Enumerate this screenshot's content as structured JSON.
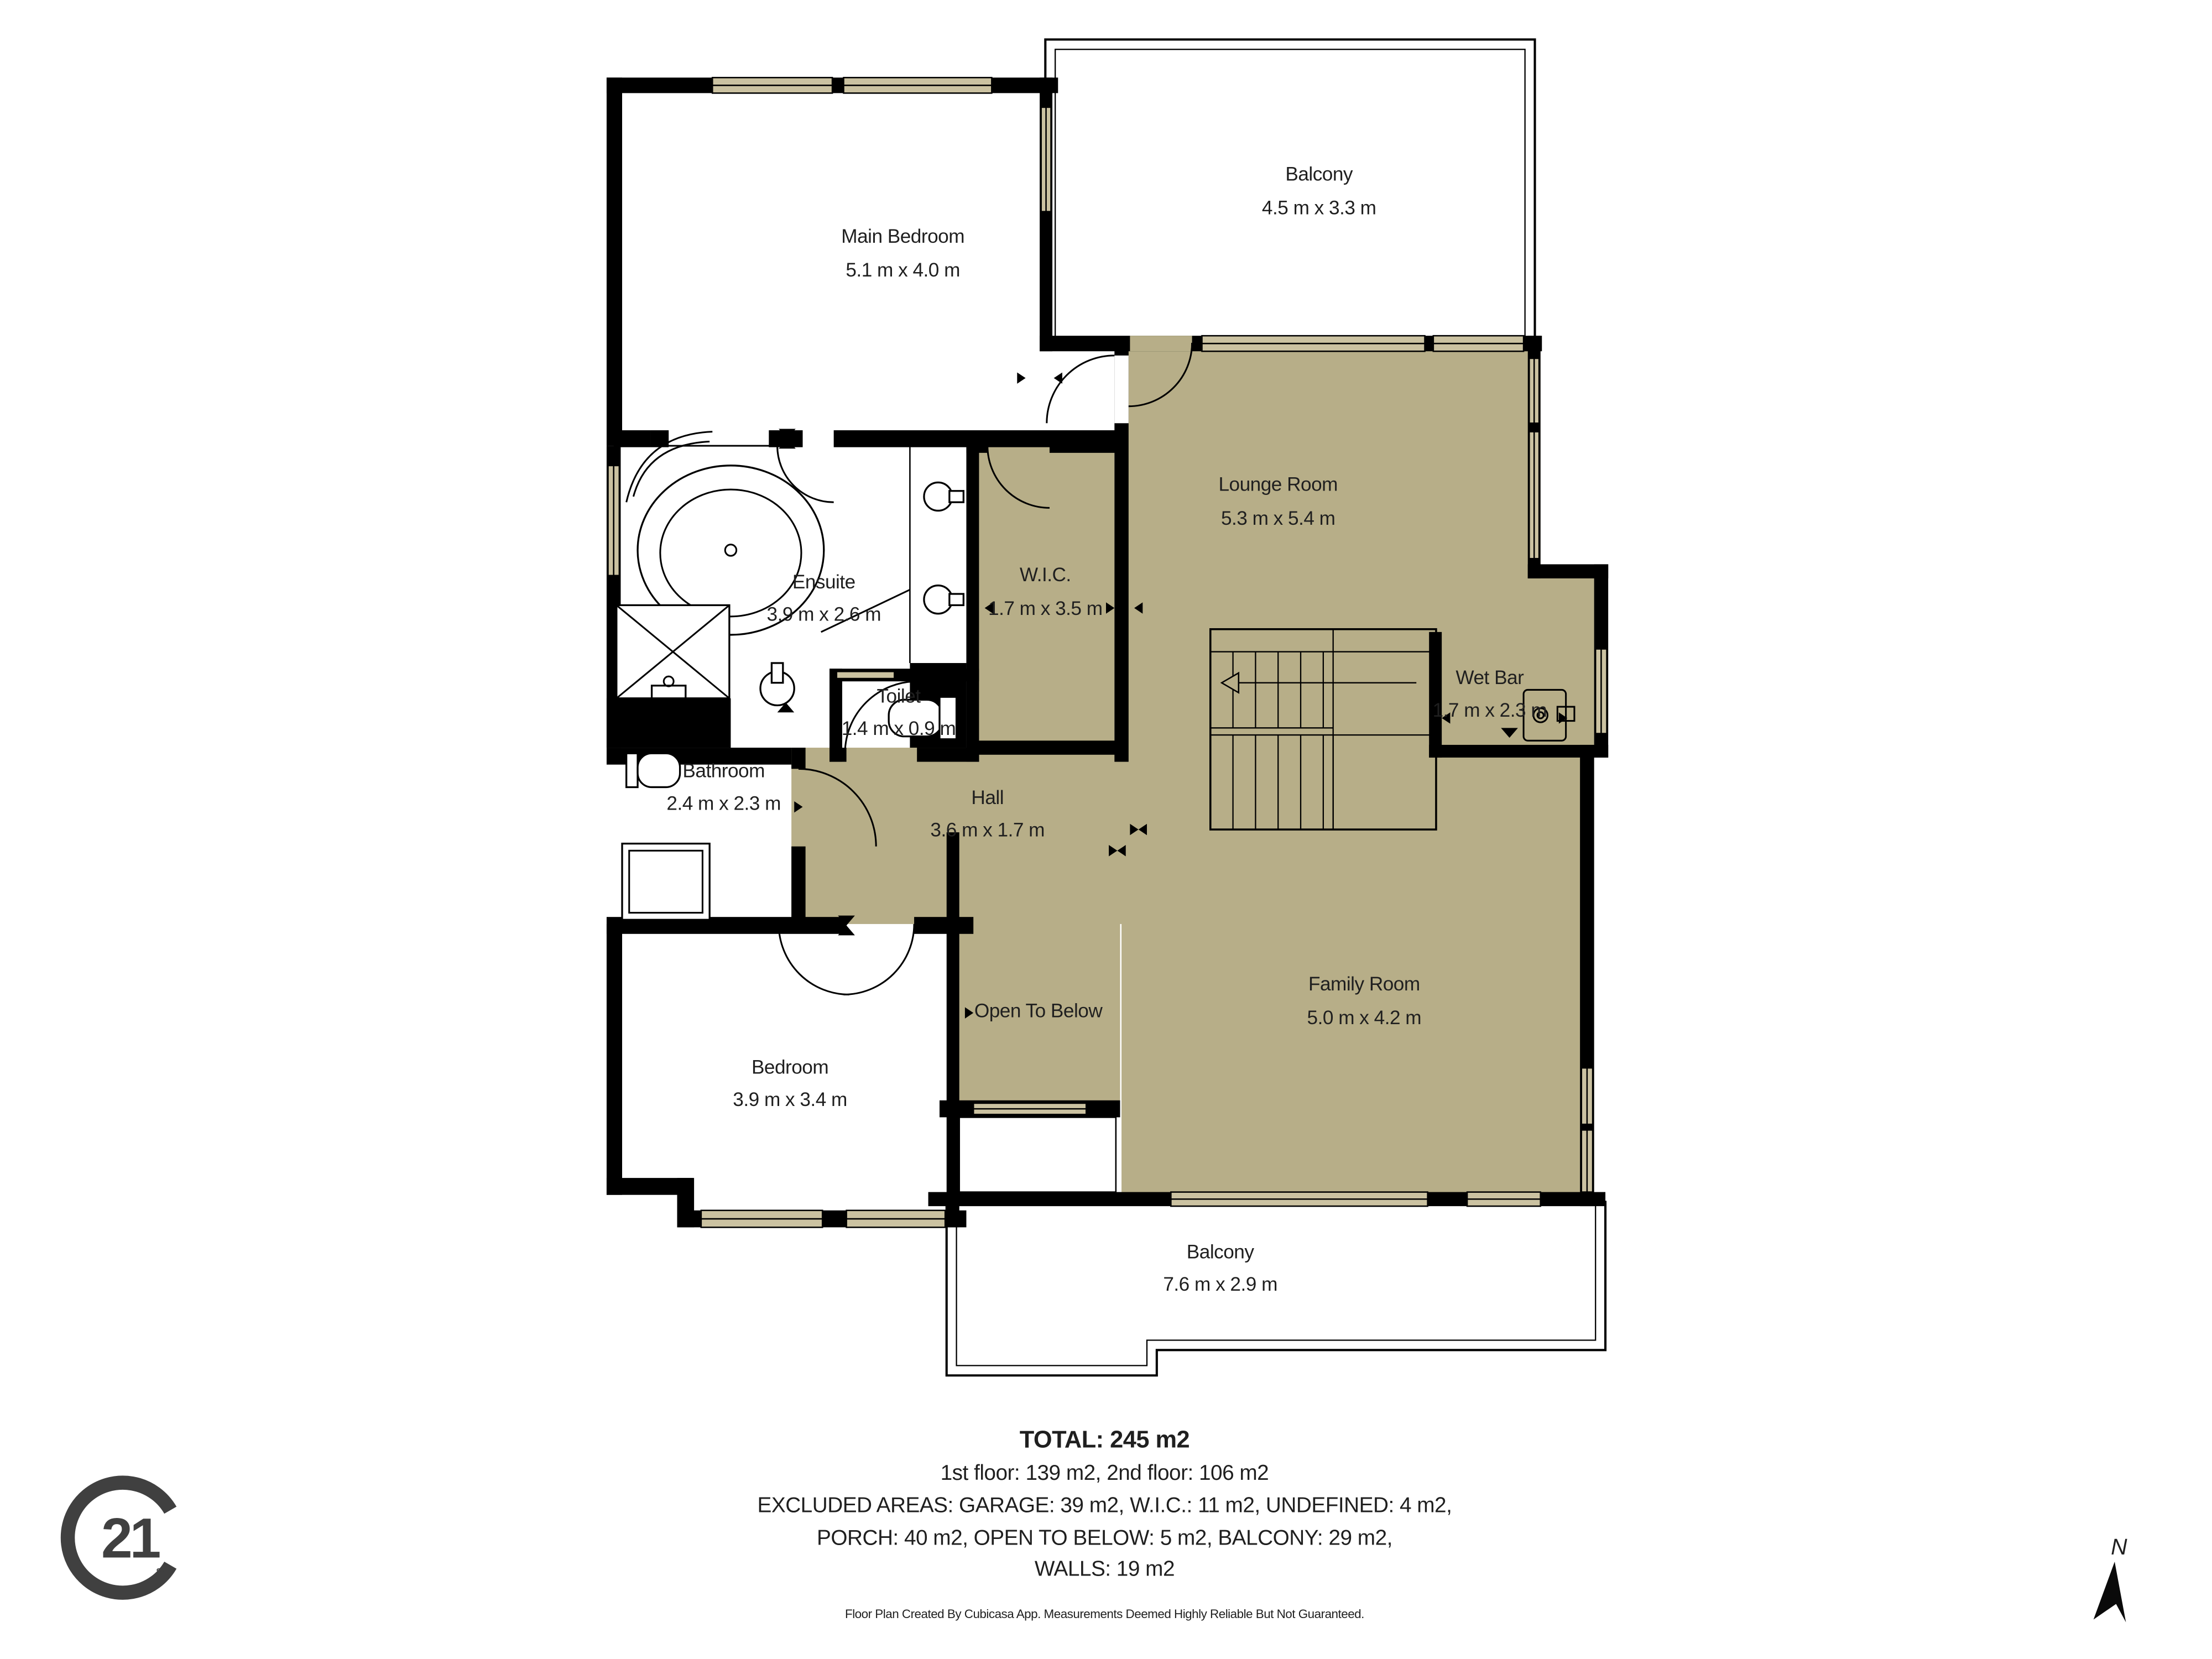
{
  "rooms": {
    "main_bedroom": {
      "name": "Main Bedroom",
      "dims": "5.1 m x 4.0 m"
    },
    "balcony_top": {
      "name": "Balcony",
      "dims": "4.5 m x 3.3 m"
    },
    "lounge": {
      "name": "Lounge Room",
      "dims": "5.3 m x 5.4 m"
    },
    "ensuite": {
      "name": "Ensuite",
      "dims": "3.9 m x 2.6 m"
    },
    "wic": {
      "name": "W.I.C.",
      "dims": "1.7 m x 3.5 m"
    },
    "toilet": {
      "name": "Toilet",
      "dims": "1.4 m x 0.9 m"
    },
    "wet_bar": {
      "name": "Wet Bar",
      "dims": "1.7 m x 2.3 m"
    },
    "bathroom": {
      "name": "Bathroom",
      "dims": "2.4 m x 2.3 m"
    },
    "hall": {
      "name": "Hall",
      "dims": "3.6 m x 1.7 m"
    },
    "family_room": {
      "name": "Family Room",
      "dims": "5.0 m x 4.2 m"
    },
    "open_to_below": {
      "name": "Open To Below"
    },
    "bedroom": {
      "name": "Bedroom",
      "dims": "3.9 m x 3.4 m"
    },
    "balcony_bottom": {
      "name": "Balcony",
      "dims": "7.6 m x 2.9 m"
    }
  },
  "summary": {
    "total": "TOTAL: 245 m2",
    "floors": "1st floor: 139 m2, 2nd floor: 106 m2",
    "excluded1": "EXCLUDED AREAS: GARAGE: 39 m2, W.I.C.: 11 m2, UNDEFINED: 4 m2,",
    "excluded2": "PORCH: 40 m2, OPEN TO BELOW: 5 m2, BALCONY: 29 m2,",
    "excluded3": "WALLS: 19 m2"
  },
  "footer": {
    "disclaimer": "Floor Plan Created By Cubicasa App. Measurements Deemed Highly Reliable But Not Guaranteed."
  },
  "logo": {
    "number": "21",
    "mark": "SM"
  },
  "compass": {
    "label": "N"
  },
  "colors": {
    "floor_fill": "#b7ae88",
    "window_fill": "#cbc2a1",
    "wall": "#000000",
    "text": "#1f1f1f",
    "logo": "#404040"
  }
}
